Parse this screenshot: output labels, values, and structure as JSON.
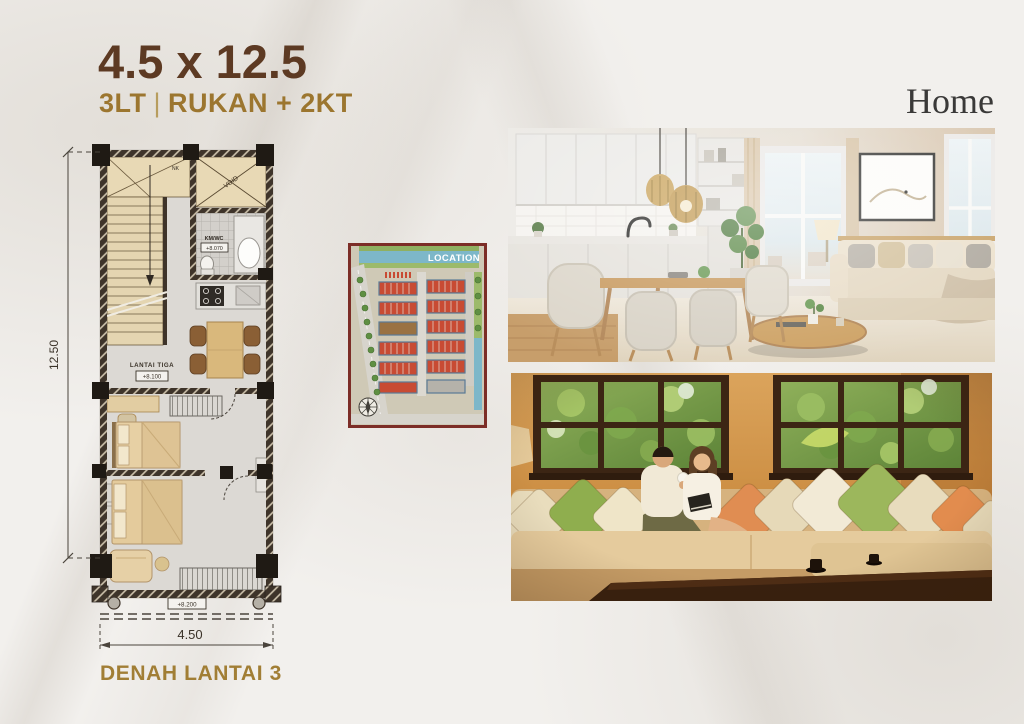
{
  "header": {
    "title": "4.5 x 12.5",
    "subtitle_left": "3LT",
    "subtitle_separator": "|",
    "subtitle_right": "RUKAN + 2KT"
  },
  "brand": {
    "name": "Home"
  },
  "floorplan": {
    "caption": "DENAH LANTAI 3",
    "dim_height": "12.50",
    "dim_width": "4.50",
    "floor_name": "LANTAI TIGA",
    "floor_level": "+8.100",
    "bathroom": "KM/WC",
    "bathroom_level": "+8.070",
    "void": "VOID",
    "stair_mark": "NK",
    "base_level": "+8.200"
  },
  "sitemap": {
    "label": "LOCATION"
  },
  "colors": {
    "title_brown": "#5d3a23",
    "accent_gold": "#9c762f",
    "map_border": "#7c2d27",
    "wall_dark": "#3e342a"
  }
}
